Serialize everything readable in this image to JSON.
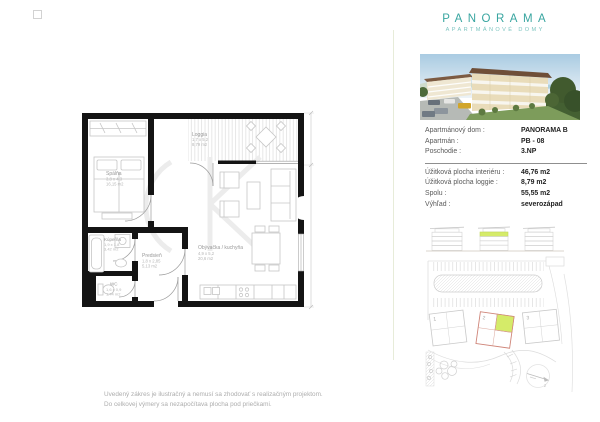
{
  "brand": {
    "title": "PANORAMA",
    "subtitle": "APARTMÁNOVÉ DOMY"
  },
  "colors": {
    "brand_teal": "#38a5a0",
    "brand_teal_light": "#7ec5c0",
    "highlight_green": "#d5eb69",
    "building_outline_red": "#cf8579"
  },
  "info": {
    "rows": [
      {
        "label": "Apartmánový dom :",
        "value": "PANORAMA B"
      },
      {
        "label": "Apartmán :",
        "value": "PB - 08"
      },
      {
        "label": "Poschodie :",
        "value": "3.NP"
      },
      {
        "label": "Úžitková plocha interiéru :",
        "value": "46,76 m2"
      },
      {
        "label": "Úžitková plocha loggie :",
        "value": "8,79 m2"
      },
      {
        "label": "Spolu :",
        "value": "55,55 m2"
      },
      {
        "label": "Výhľad :",
        "value": "severozápad"
      }
    ]
  },
  "floor_plan": {
    "rooms": [
      {
        "name": "Spálňa",
        "dims": "3,8 x 4,3",
        "area": "16,15 m2"
      },
      {
        "name": "Loggia",
        "dims": "1,7 x 5,2",
        "area": "8,79 m2"
      },
      {
        "name": "Kúpeľňa",
        "dims": "1,9 x 1,8",
        "area": "3,42 m2"
      },
      {
        "name": "Predsieň",
        "dims": "1,8 x 2,85",
        "area": "5,13 m2"
      },
      {
        "name": "WC",
        "dims": "1,6 x 0,9",
        "area": "1,44 m2"
      },
      {
        "name": "Obývačka / kuchyňa",
        "dims": "4,9 x 5,2",
        "area": "20,6 m2"
      }
    ]
  },
  "site_plan": {
    "building_labels": [
      "1",
      "2",
      "3"
    ],
    "compass_label": "z"
  },
  "disclaimer": {
    "line1": "Uvedený zákres je ilustračný a nemusí sa zhodovať s realizačným projektom.",
    "line2": "Do celkovej výmery sa nezapočítava plocha pod priečkami."
  }
}
